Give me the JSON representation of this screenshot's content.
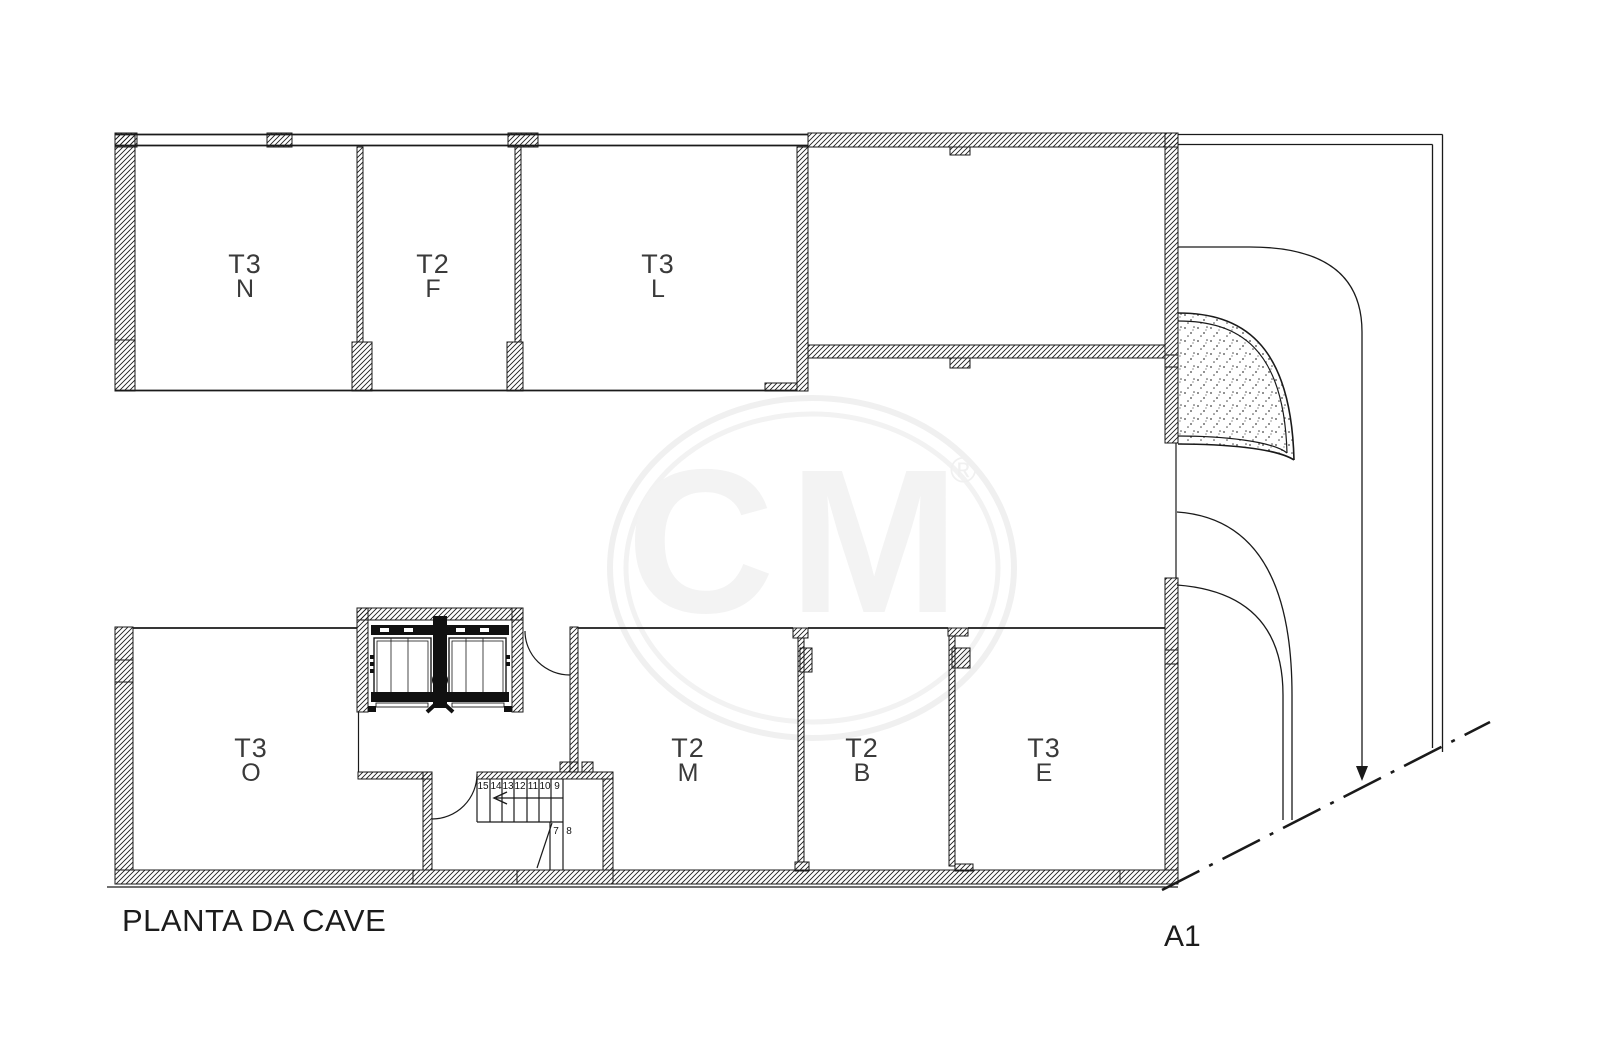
{
  "title": {
    "plan_label": "PLANTA DA CAVE",
    "sheet_label": "A1"
  },
  "watermark": {
    "letters": "CM",
    "registered": "®"
  },
  "rooms": [
    {
      "code": "T3",
      "letter": "N"
    },
    {
      "code": "T2",
      "letter": "F"
    },
    {
      "code": "T3",
      "letter": "L"
    },
    {
      "code": "T3",
      "letter": "O"
    },
    {
      "code": "T2",
      "letter": "M"
    },
    {
      "code": "T2",
      "letter": "B"
    },
    {
      "code": "T3",
      "letter": "E"
    }
  ],
  "stairs": {
    "upper_steps": [
      "15",
      "14",
      "13",
      "12",
      "11",
      "10",
      "9"
    ],
    "lower_steps": [
      "7",
      "8"
    ]
  },
  "colors": {
    "line": "#1a1a1a",
    "watermark": "#f1f1f1"
  }
}
